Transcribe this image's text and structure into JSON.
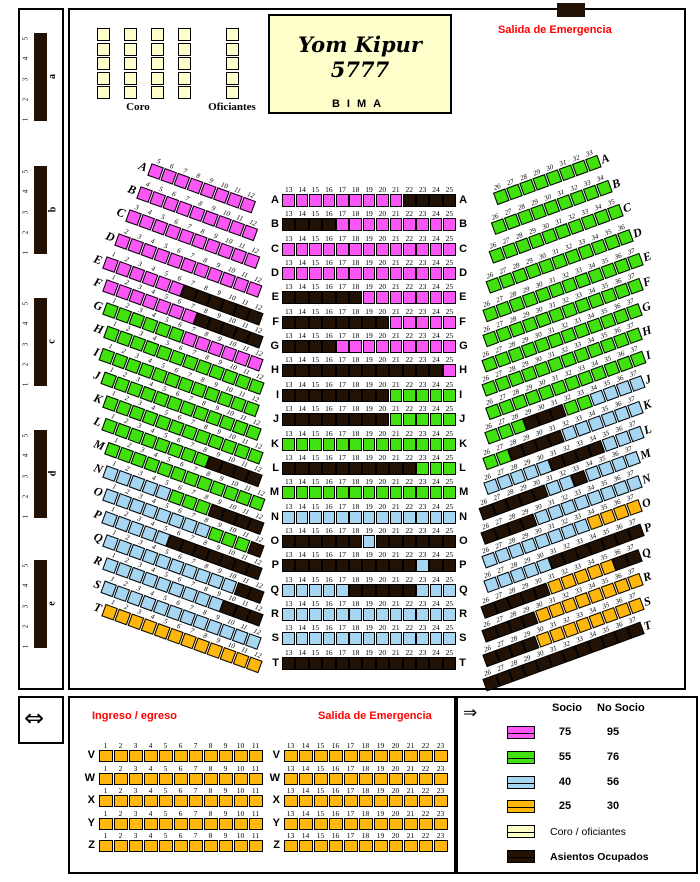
{
  "title": "Yom Kipur 5777",
  "bima": "BIMA",
  "labels": {
    "coro": "Coro",
    "oficiantes": "Oficiantes",
    "salida_top": "Salida de Emergencia",
    "ingreso": "Ingreso / egreso",
    "salida_bottom": "Salida de Emergencia"
  },
  "icons": {
    "exit_double_arrow": "⇔",
    "exit_right_arrow": "⇒"
  },
  "colors": {
    "pink": "#fb57f7",
    "green": "#41e00f",
    "blue": "#a6d6f2",
    "orange": "#ffb60d",
    "cream": "#ffffcc",
    "black": "#221205",
    "red": "#ff0000"
  },
  "legend": {
    "header": {
      "socio": "Socio",
      "no_socio": "No Socio"
    },
    "items": [
      {
        "color": "pink",
        "socio": "75",
        "no_socio": "95"
      },
      {
        "color": "green",
        "socio": "55",
        "no_socio": "76"
      },
      {
        "color": "blue",
        "socio": "40",
        "no_socio": "56"
      },
      {
        "color": "orange",
        "socio": "25",
        "no_socio": "30"
      },
      {
        "color": "cream",
        "label": "Coro / oficiantes"
      },
      {
        "color": "black",
        "label": "Asientos Ocupados",
        "bold": true
      }
    ]
  },
  "side_sections": {
    "letters": [
      "a",
      "b",
      "c",
      "d",
      "e"
    ],
    "numbers": [
      "1",
      "2",
      "3",
      "4",
      "5"
    ]
  },
  "coro": {
    "columns": 4,
    "seats_per_column": 5
  },
  "oficiantes": {
    "columns": 1,
    "seats_per_column": 5
  },
  "left_section": {
    "rows": [
      {
        "l": "A",
        "s": 5,
        "r": [
          [
            "pink",
            8
          ]
        ]
      },
      {
        "l": "B",
        "s": 4,
        "r": [
          [
            "pink",
            9
          ]
        ]
      },
      {
        "l": "C",
        "s": 3,
        "r": [
          [
            "pink",
            10
          ]
        ]
      },
      {
        "l": "D",
        "s": 2,
        "r": [
          [
            "pink",
            11
          ]
        ]
      },
      {
        "l": "E",
        "s": 1,
        "r": [
          [
            "pink",
            6
          ],
          [
            "black",
            6
          ]
        ]
      },
      {
        "l": "F",
        "s": 1,
        "r": [
          [
            "pink",
            7
          ],
          [
            "black",
            5
          ]
        ]
      },
      {
        "l": "G",
        "s": 1,
        "r": [
          [
            "green",
            6
          ],
          [
            "pink",
            6
          ]
        ]
      },
      {
        "l": "H",
        "s": 1,
        "r": [
          [
            "green",
            12
          ]
        ]
      },
      {
        "l": "I",
        "s": 1,
        "r": [
          [
            "green",
            12
          ]
        ]
      },
      {
        "l": "J",
        "s": 1,
        "r": [
          [
            "green",
            12
          ]
        ]
      },
      {
        "l": "K",
        "s": 1,
        "r": [
          [
            "green",
            12
          ]
        ]
      },
      {
        "l": "L",
        "s": 1,
        "r": [
          [
            "green",
            8
          ],
          [
            "black",
            4
          ]
        ]
      },
      {
        "l": "M",
        "s": 1,
        "r": [
          [
            "green",
            12
          ]
        ]
      },
      {
        "l": "N",
        "s": 1,
        "r": [
          [
            "blue",
            5
          ],
          [
            "green",
            3
          ],
          [
            "black",
            4
          ]
        ]
      },
      {
        "l": "O",
        "s": 1,
        "r": [
          [
            "blue",
            8
          ],
          [
            "green",
            3
          ],
          [
            "black",
            1
          ]
        ]
      },
      {
        "l": "P",
        "s": 1,
        "r": [
          [
            "blue",
            5
          ],
          [
            "black",
            7
          ]
        ]
      },
      {
        "l": "Q",
        "s": 1,
        "r": [
          [
            "blue",
            10
          ],
          [
            "black",
            2
          ]
        ]
      },
      {
        "l": "R",
        "s": 1,
        "r": [
          [
            "blue",
            9
          ],
          [
            "black",
            3
          ]
        ]
      },
      {
        "l": "S",
        "s": 1,
        "r": [
          [
            "blue",
            12
          ]
        ]
      },
      {
        "l": "T",
        "s": 1,
        "r": [
          [
            "orange",
            12
          ]
        ]
      }
    ]
  },
  "center_section": {
    "rows": [
      {
        "l": "A",
        "s": 13,
        "r": [
          [
            "pink",
            9
          ],
          [
            "black",
            4
          ]
        ]
      },
      {
        "l": "B",
        "s": 13,
        "r": [
          [
            "black",
            4
          ],
          [
            "pink",
            9
          ]
        ]
      },
      {
        "l": "C",
        "s": 13,
        "r": [
          [
            "pink",
            13
          ]
        ]
      },
      {
        "l": "D",
        "s": 13,
        "r": [
          [
            "pink",
            13
          ]
        ]
      },
      {
        "l": "E",
        "s": 13,
        "r": [
          [
            "black",
            6
          ],
          [
            "pink",
            7
          ]
        ]
      },
      {
        "l": "F",
        "s": 13,
        "r": [
          [
            "black",
            8
          ],
          [
            "pink",
            5
          ]
        ]
      },
      {
        "l": "G",
        "s": 13,
        "r": [
          [
            "black",
            4
          ],
          [
            "pink",
            9
          ]
        ]
      },
      {
        "l": "H",
        "s": 13,
        "r": [
          [
            "black",
            12
          ],
          [
            "pink",
            1
          ]
        ]
      },
      {
        "l": "I",
        "s": 13,
        "r": [
          [
            "black",
            8
          ],
          [
            "green",
            5
          ]
        ]
      },
      {
        "l": "J",
        "s": 13,
        "r": [
          [
            "black",
            8
          ],
          [
            "green",
            5
          ]
        ]
      },
      {
        "l": "K",
        "s": 13,
        "r": [
          [
            "green",
            13
          ]
        ]
      },
      {
        "l": "L",
        "s": 13,
        "r": [
          [
            "black",
            10
          ],
          [
            "green",
            3
          ]
        ]
      },
      {
        "l": "M",
        "s": 13,
        "r": [
          [
            "green",
            13
          ]
        ]
      },
      {
        "l": "N",
        "s": 13,
        "r": [
          [
            "blue",
            13
          ]
        ]
      },
      {
        "l": "O",
        "s": 13,
        "r": [
          [
            "black",
            6
          ],
          [
            "blue",
            1
          ],
          [
            "black",
            6
          ]
        ]
      },
      {
        "l": "P",
        "s": 13,
        "r": [
          [
            "black",
            10
          ],
          [
            "blue",
            1
          ],
          [
            "black",
            2
          ]
        ]
      },
      {
        "l": "Q",
        "s": 13,
        "r": [
          [
            "blue",
            5
          ],
          [
            "black",
            5
          ],
          [
            "blue",
            3
          ]
        ]
      },
      {
        "l": "R",
        "s": 13,
        "r": [
          [
            "blue",
            13
          ]
        ]
      },
      {
        "l": "S",
        "s": 13,
        "r": [
          [
            "blue",
            13
          ]
        ]
      },
      {
        "l": "T",
        "s": 13,
        "r": [
          [
            "black",
            13
          ]
        ]
      }
    ]
  },
  "right_section": {
    "rows": [
      {
        "l": "A",
        "s": 26,
        "r": [
          [
            "green",
            8
          ]
        ]
      },
      {
        "l": "B",
        "s": 26,
        "r": [
          [
            "green",
            9
          ]
        ]
      },
      {
        "l": "C",
        "s": 26,
        "r": [
          [
            "green",
            10
          ]
        ]
      },
      {
        "l": "D",
        "s": 26,
        "r": [
          [
            "green",
            11
          ]
        ]
      },
      {
        "l": "E",
        "s": 26,
        "r": [
          [
            "green",
            12
          ]
        ]
      },
      {
        "l": "F",
        "s": 26,
        "r": [
          [
            "green",
            12
          ]
        ]
      },
      {
        "l": "G",
        "s": 26,
        "r": [
          [
            "green",
            12
          ]
        ]
      },
      {
        "l": "H",
        "s": 26,
        "r": [
          [
            "green",
            12
          ]
        ]
      },
      {
        "l": "I",
        "s": 26,
        "r": [
          [
            "green",
            12
          ]
        ]
      },
      {
        "l": "J",
        "s": 26,
        "r": [
          [
            "green",
            3
          ],
          [
            "black",
            3
          ],
          [
            "green",
            2
          ],
          [
            "blue",
            4
          ]
        ]
      },
      {
        "l": "K",
        "s": 26,
        "r": [
          [
            "green",
            2
          ],
          [
            "black",
            4
          ],
          [
            "blue",
            6
          ]
        ]
      },
      {
        "l": "L",
        "s": 26,
        "r": [
          [
            "blue",
            5
          ],
          [
            "black",
            4
          ],
          [
            "blue",
            3
          ]
        ]
      },
      {
        "l": "M",
        "s": 26,
        "r": [
          [
            "black",
            5
          ],
          [
            "blue",
            2
          ],
          [
            "black",
            1
          ],
          [
            "blue",
            4
          ]
        ]
      },
      {
        "l": "N",
        "s": 26,
        "r": [
          [
            "black",
            4
          ],
          [
            "blue",
            8
          ]
        ]
      },
      {
        "l": "O",
        "s": 26,
        "r": [
          [
            "blue",
            8
          ],
          [
            "orange",
            4
          ]
        ]
      },
      {
        "l": "P",
        "s": 26,
        "r": [
          [
            "blue",
            5
          ],
          [
            "black",
            7
          ]
        ]
      },
      {
        "l": "Q",
        "s": 26,
        "r": [
          [
            "black",
            5
          ],
          [
            "orange",
            5
          ],
          [
            "black",
            2
          ]
        ]
      },
      {
        "l": "R",
        "s": 26,
        "r": [
          [
            "black",
            4
          ],
          [
            "orange",
            8
          ]
        ]
      },
      {
        "l": "S",
        "s": 26,
        "r": [
          [
            "black",
            4
          ],
          [
            "orange",
            8
          ]
        ]
      },
      {
        "l": "T",
        "s": 26,
        "r": [
          [
            "black",
            12
          ]
        ]
      }
    ]
  },
  "bottom_left_section": {
    "rows": [
      {
        "l": "V",
        "s": 1,
        "r": [
          [
            "orange",
            11
          ]
        ]
      },
      {
        "l": "W",
        "s": 1,
        "r": [
          [
            "orange",
            11
          ]
        ]
      },
      {
        "l": "X",
        "s": 1,
        "r": [
          [
            "orange",
            11
          ]
        ]
      },
      {
        "l": "Y",
        "s": 1,
        "r": [
          [
            "orange",
            11
          ]
        ]
      },
      {
        "l": "Z",
        "s": 1,
        "r": [
          [
            "orange",
            11
          ]
        ]
      }
    ]
  },
  "bottom_right_section": {
    "rows": [
      {
        "l": "V",
        "s": 13,
        "r": [
          [
            "orange",
            11
          ]
        ]
      },
      {
        "l": "W",
        "s": 13,
        "r": [
          [
            "orange",
            11
          ]
        ]
      },
      {
        "l": "X",
        "s": 13,
        "r": [
          [
            "orange",
            11
          ]
        ]
      },
      {
        "l": "Y",
        "s": 13,
        "r": [
          [
            "orange",
            11
          ]
        ]
      },
      {
        "l": "Z",
        "s": 13,
        "r": [
          [
            "orange",
            11
          ]
        ]
      }
    ]
  }
}
